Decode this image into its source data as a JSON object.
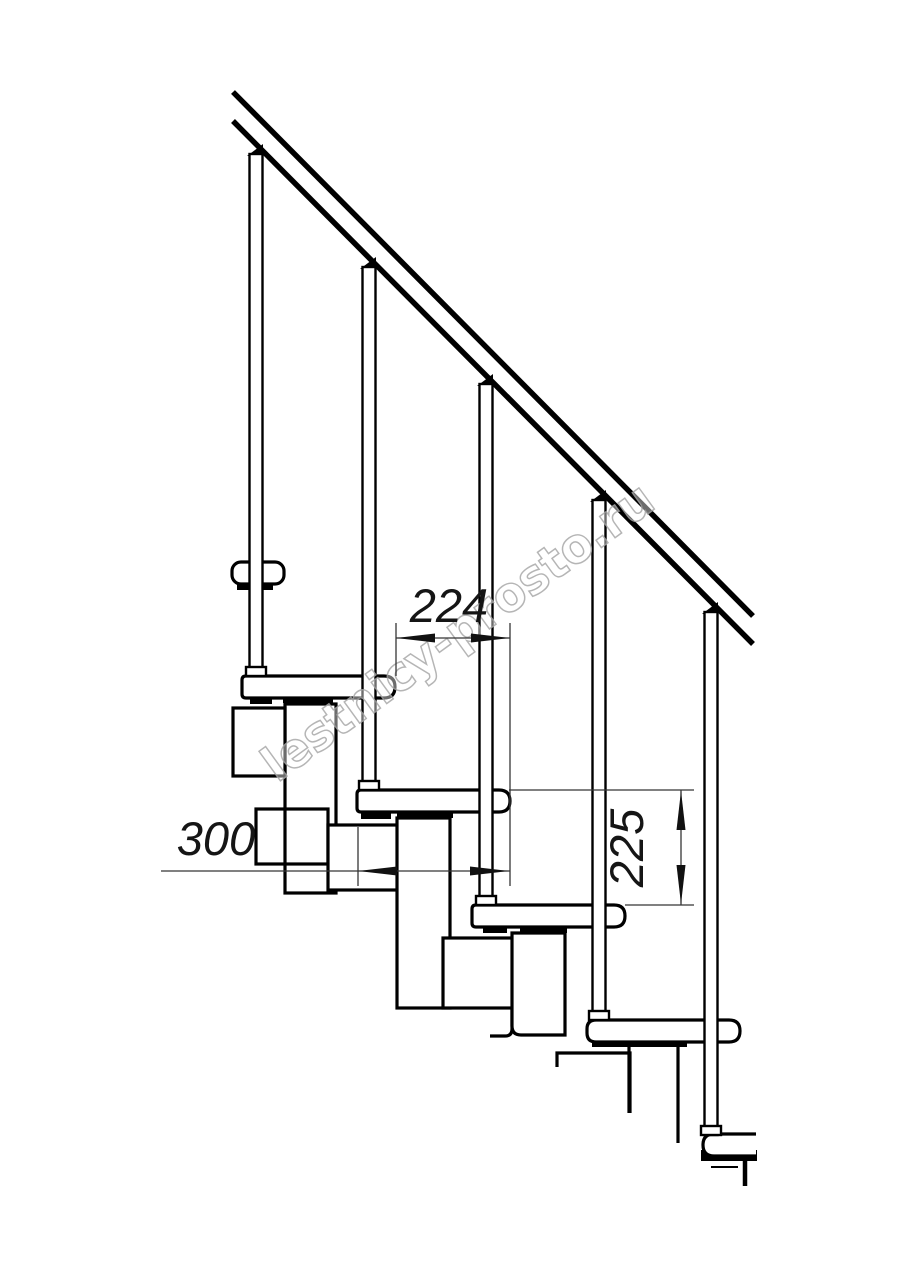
{
  "document": {
    "type": "technical line drawing",
    "subject": "modular staircase side elevation with handrail"
  },
  "colors": {
    "background": "#ffffff",
    "line": "#000000",
    "dimension": "#353535",
    "watermark": "#a9a9a9"
  },
  "dimensions": {
    "run": {
      "value": "224",
      "orientation": "horizontal"
    },
    "tread_length": {
      "value": "300",
      "orientation": "horizontal"
    },
    "rise": {
      "value": "225",
      "orientation": "vertical"
    }
  },
  "components": {
    "balusters": 5,
    "treads": 5,
    "support_modules": 5,
    "handrail": "diagonal double line"
  },
  "watermark": {
    "text": "lestnicy-prosto.ru"
  }
}
